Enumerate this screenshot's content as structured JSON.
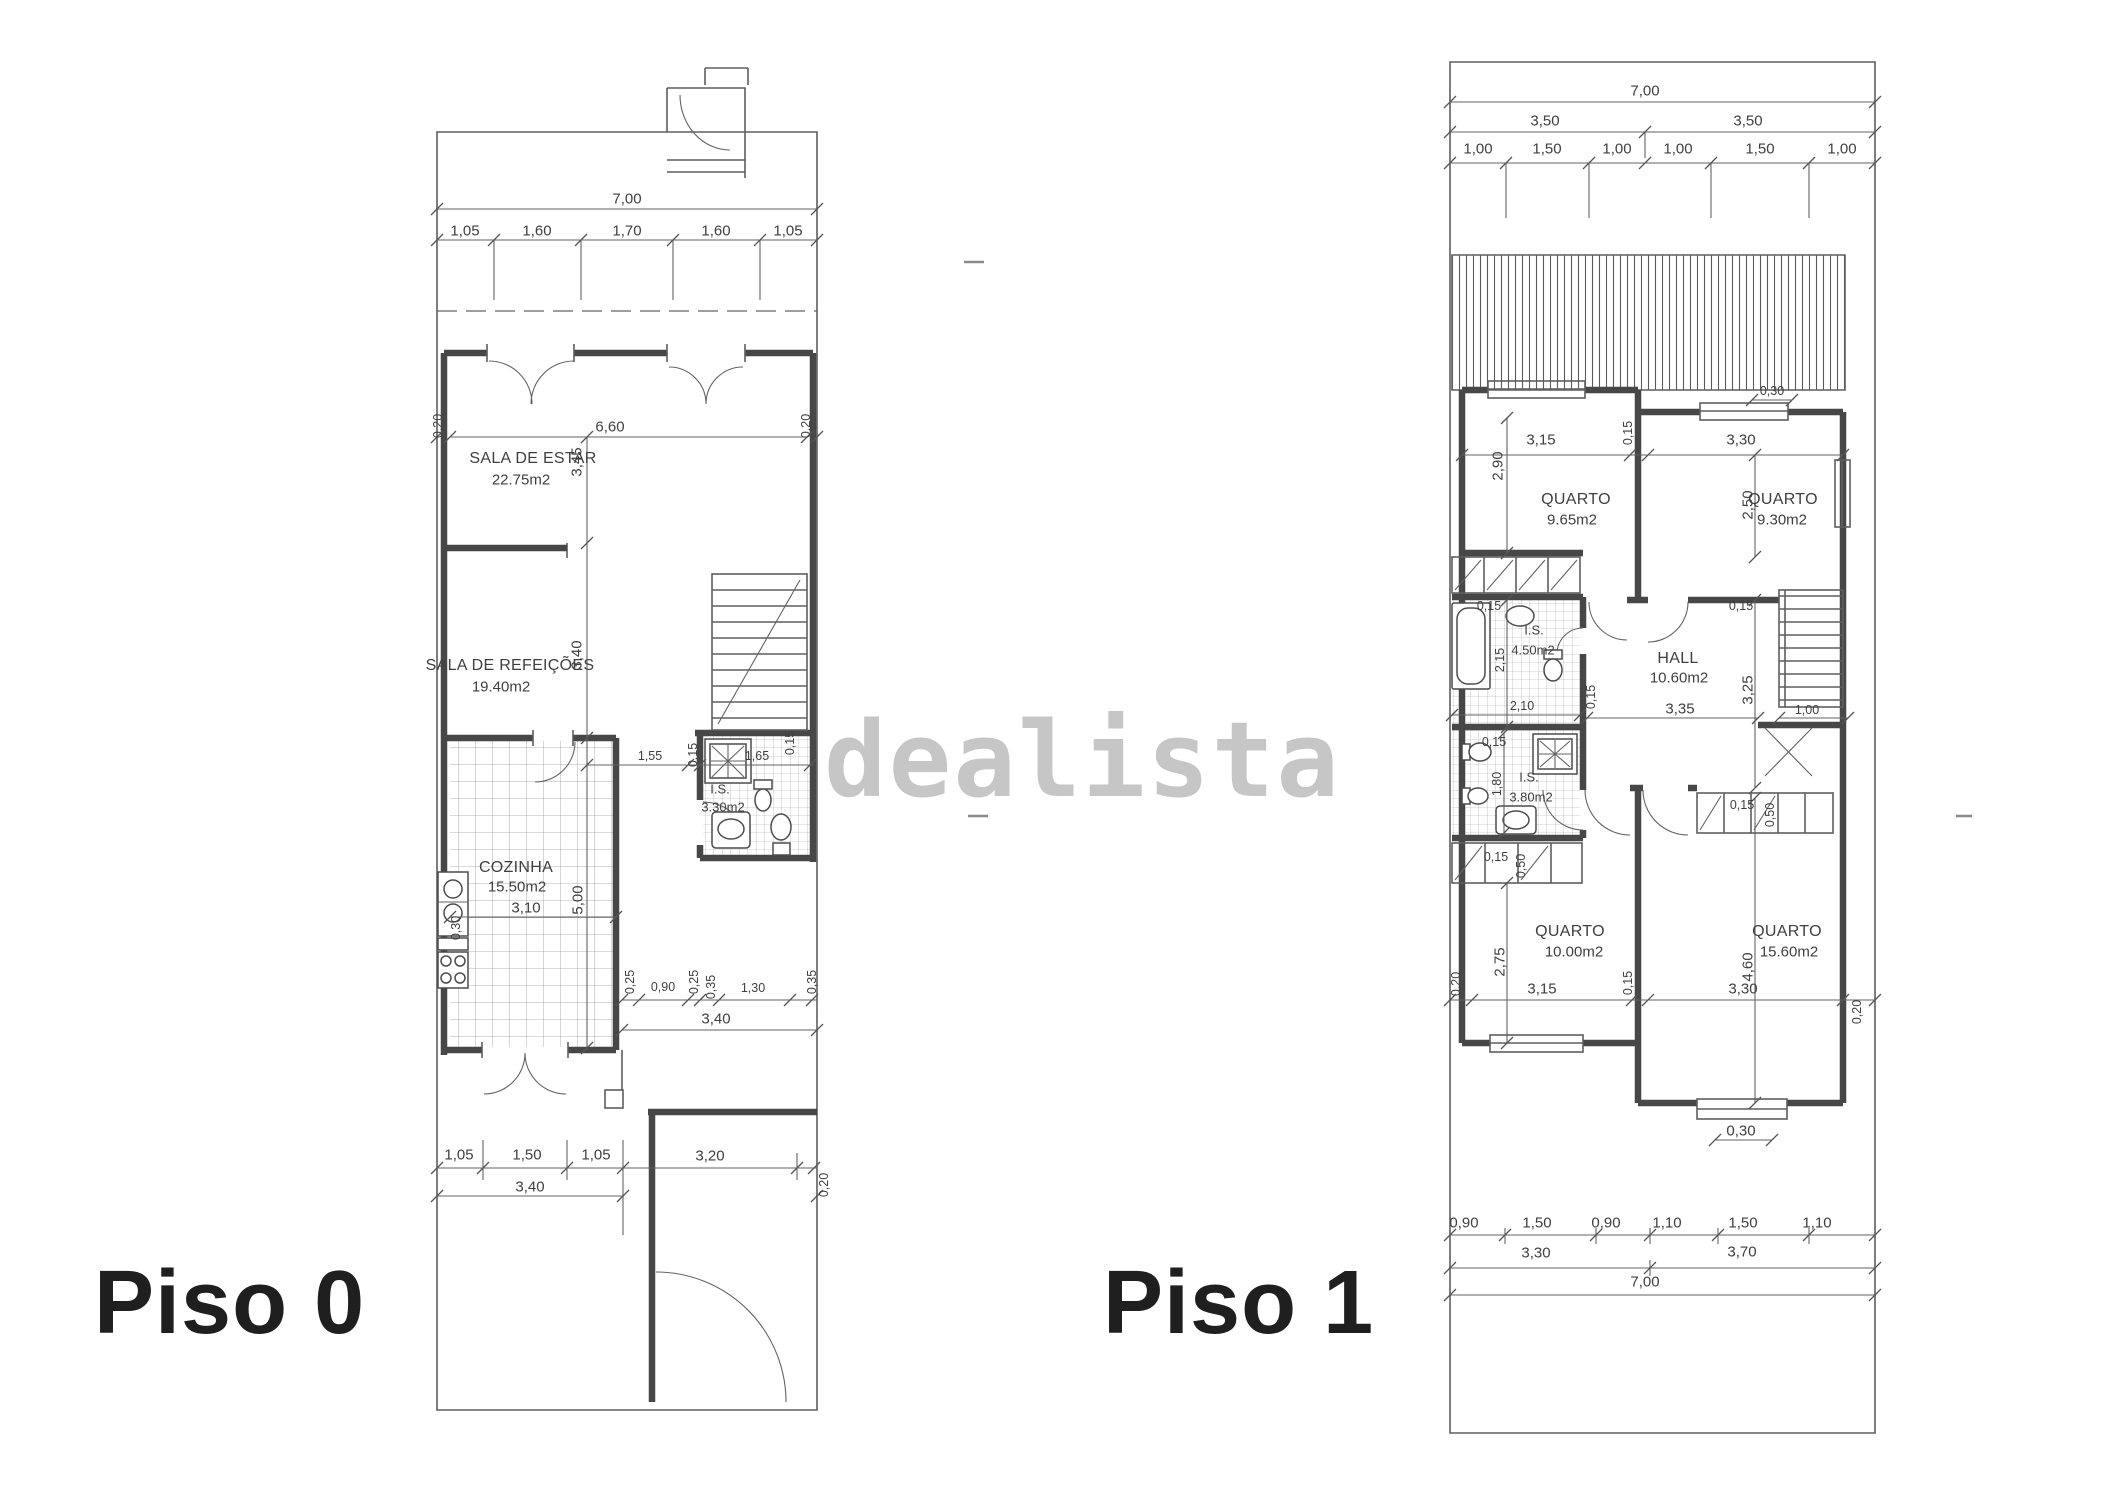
{
  "watermark": "dealista",
  "floor0": {
    "label": "Piso 0",
    "rooms": {
      "sala_estar": {
        "name": "SALA DE ESTAR",
        "area": "22.75m2"
      },
      "sala_refeicoes": {
        "name": "SALA DE REFEIÇÕES",
        "area": "19.40m2"
      },
      "cozinha": {
        "name": "COZINHA",
        "area": "15.50m2"
      },
      "is": {
        "name": "I.S.",
        "area": "3.30m2"
      }
    },
    "dims": {
      "top_total": "7,00",
      "top_segs": [
        "1,05",
        "1,60",
        "1,70",
        "1,60",
        "1,05"
      ],
      "upper_left": "0,20",
      "upper_width": "6,60",
      "upper_right": "0,20",
      "sala_estar_h": "3,45",
      "sala_refeicoes_h": "3,40",
      "bath_row": [
        "1,55",
        "0,15",
        "1,65",
        "0,15"
      ],
      "kitchen_w": "3,10",
      "kitchen_h": "5,00",
      "counter": "0,30",
      "mid_segs": [
        "0,25",
        "0,90",
        "0,25",
        "0,35",
        "1,30",
        "0,35"
      ],
      "mid_total": "3,40",
      "bottom_segs": [
        "1,05",
        "1,50",
        "1,05",
        "3,20"
      ],
      "bottom_total": "3,40",
      "bottom_right": "0,20"
    }
  },
  "floor1": {
    "label": "Piso 1",
    "rooms": {
      "quarto1": {
        "name": "QUARTO",
        "area": "9.65m2"
      },
      "quarto2": {
        "name": "QUARTO",
        "area": "9.30m2"
      },
      "hall": {
        "name": "HALL",
        "area": "10.60m2"
      },
      "is1": {
        "name": "I.S.",
        "area": "4.50m2"
      },
      "is2": {
        "name": "I.S.",
        "area": "3.80m2"
      },
      "quarto3": {
        "name": "QUARTO",
        "area": "10.00m2"
      },
      "quarto4": {
        "name": "QUARTO",
        "area": "15.60m2"
      }
    },
    "dims": {
      "top_total": "7,00",
      "top_halves": [
        "3,50",
        "3,50"
      ],
      "top_segs": [
        "1,00",
        "1,50",
        "1,00",
        "1,00",
        "1,50",
        "1,00"
      ],
      "terrace_offset": "0,30",
      "q1_w": "3,15",
      "sep_top": "0,15",
      "q2_w": "3,30",
      "q1_h": "2,90",
      "q2_h": "2,50",
      "bath1_off": "0,15",
      "bath1_h": "2,15",
      "bath1_w": "2,10",
      "hall_w": "3,35",
      "hall_h": "3,25",
      "hall_off_left": "0,15",
      "hall_off_top": "0,15",
      "stairs_w": "1,00",
      "bath2_h": "1,80",
      "bath2_off": "0,15",
      "ward_right_off": "0,15",
      "ward_right_d": "0,50",
      "ward_left_off": "0,15",
      "ward_left_d": "0,50",
      "q3_h": "2,75",
      "q3_w": "3,15",
      "sep_bottom": "0,15",
      "q4_w": "3,30",
      "q4_h": "4,60",
      "edge_left": "0,20",
      "edge_right": "0,20",
      "bay_off": "0,30",
      "bottom_segs": [
        "0,90",
        "1,50",
        "0,90",
        "1,10",
        "1,50",
        "1,10"
      ],
      "bottom_halves": [
        "3,30",
        "3,70"
      ],
      "bottom_total": "7,00"
    }
  }
}
